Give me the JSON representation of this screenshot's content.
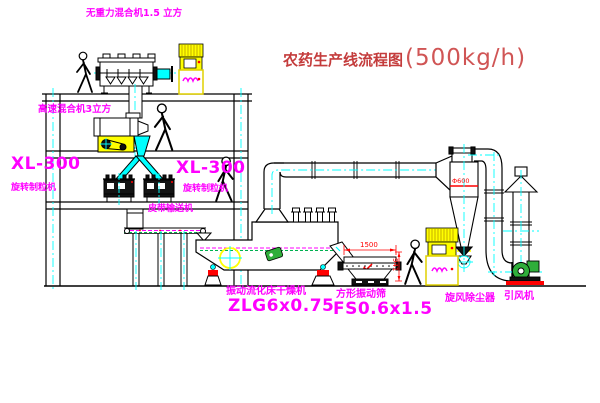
{
  "title": {
    "text": "农药生产线流程图",
    "capacity": "(500kg/h)"
  },
  "labels": {
    "gravity_mixer": "无重力混合机1.5 立方",
    "high_speed_mixer": "高速混合机3立方",
    "granulator_left": {
      "model": "XL-300",
      "name": "旋转制粒机"
    },
    "granulator_mid": {
      "model": "XL-300",
      "name": "旋转制粒机"
    },
    "belt_conveyor": "皮带输送机",
    "dryer": {
      "name": "振动流化床干燥机",
      "model": "ZLG6x0.75"
    },
    "sieve": {
      "name": "方形振动筛",
      "model": "FS0.6x1.5"
    },
    "cyclone": "旋风除尘器",
    "fan": "引风机"
  },
  "dimensions": {
    "sieve_length": "1500",
    "sieve_height": "941",
    "cyclone_inlet": "Φ600"
  },
  "colors": {
    "line": "#000000",
    "centerline_cyan": "#00ffff",
    "label_magenta": "#ff00ff",
    "title_red": "#c43c3c",
    "dimension_red": "#ff0000",
    "cabinet_yellow": "#ffff00",
    "machine_green": "#2fae3a"
  }
}
